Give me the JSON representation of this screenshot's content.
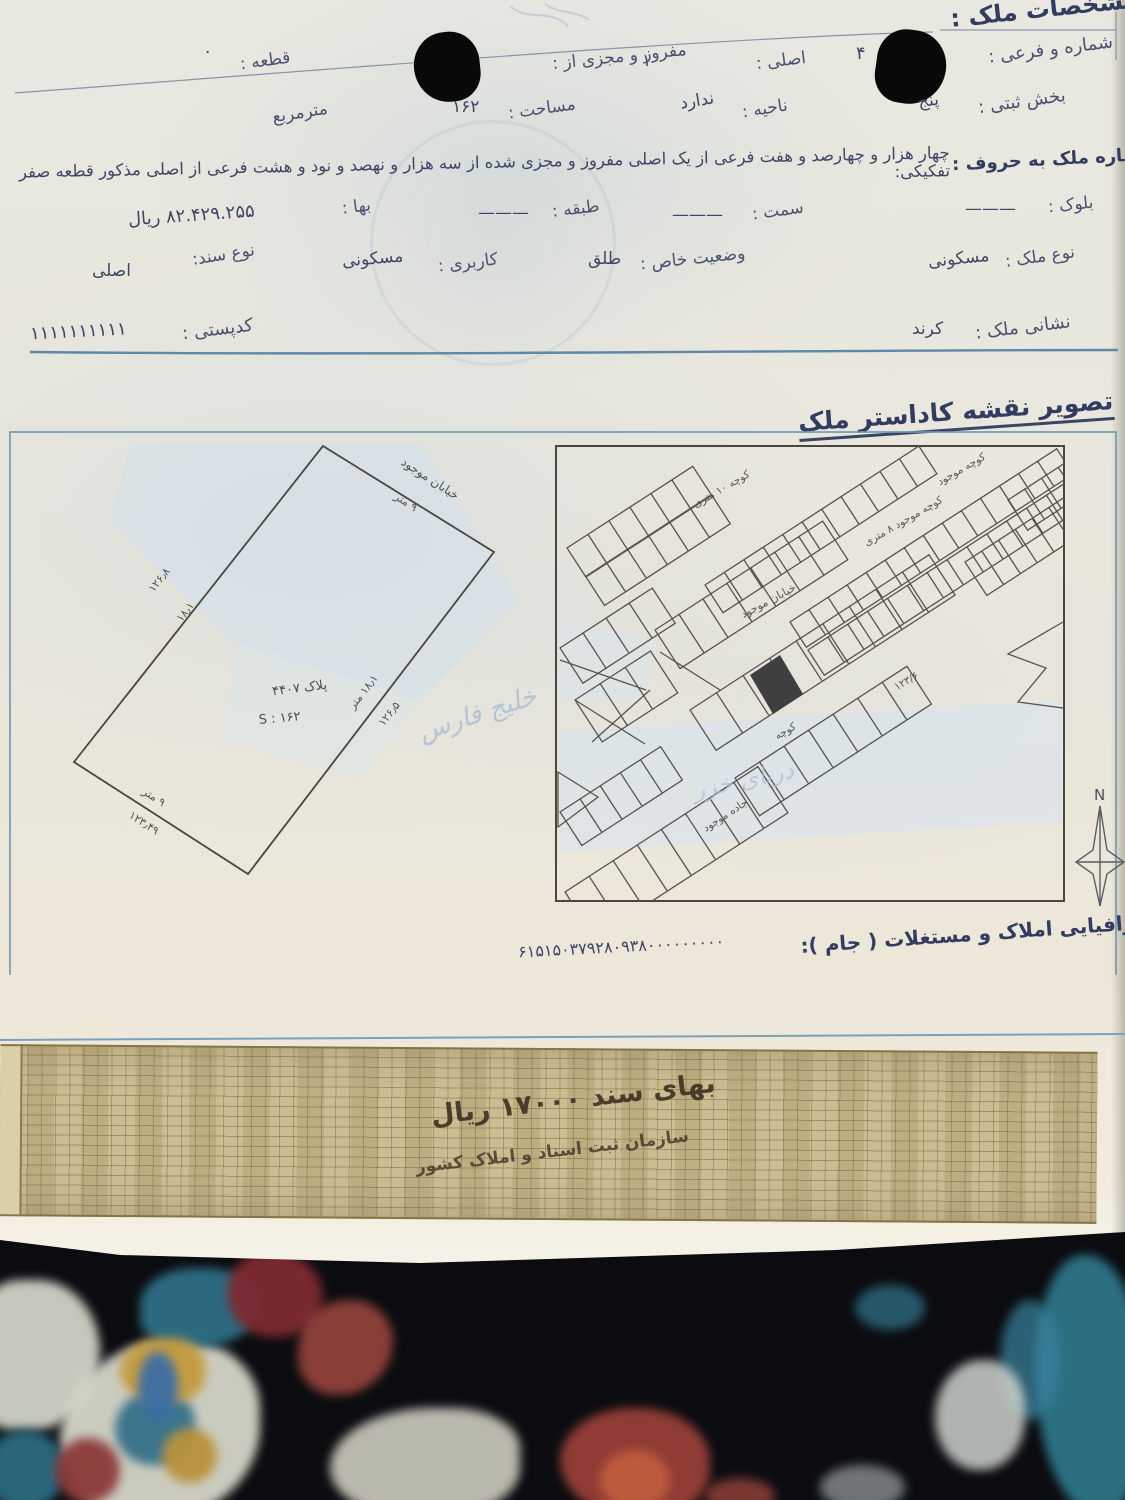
{
  "document": {
    "section1_title": "مشخصات ملک :",
    "fields": {
      "shomare_farei": {
        "label": "شماره و فرعی :",
        "value": "۴"
      },
      "asli": {
        "label": "اصلی :",
        "value": "۱"
      },
      "mafruz": {
        "label": "مفروز و مجزی از :",
        "value": ""
      },
      "ghateh": {
        "label": "قطعه :",
        "value": "·"
      },
      "bakhsh_sabti": {
        "label": "بخش ثبتی :",
        "value": "پنج"
      },
      "nahieh": {
        "label": "ناحیه :",
        "value": "ندارد"
      },
      "masahat": {
        "label": "مساحت :",
        "value": "۱۶۲"
      },
      "unit": "مترمربع",
      "melk_horoof": {
        "label": "شماره ملک به حروف :",
        "value": "چهار هزار و چهارصد و هفت فرعی از یک اصلی مفروز و مجزی شده از سه هزار و نهصد و نود و هشت فرعی از اصلی مذکور قطعه صفر تفکیکی:"
      },
      "block": {
        "label": "بلوک :",
        "value": "———"
      },
      "samt": {
        "label": "سمت :",
        "value": "———"
      },
      "tabagheh": {
        "label": "طبقه :",
        "value": "———"
      },
      "baha": {
        "label": "بها :",
        "value": "۸۲.۴۲۹.۲۵۵ ریال"
      },
      "noe_melk": {
        "label": "نوع ملک :",
        "value": "مسکونی"
      },
      "vaziat_khas": {
        "label": "وضعیت خاص :",
        "value": "طلق"
      },
      "karbari": {
        "label": "کاربری :",
        "value": "مسکونی"
      },
      "noe_sanad": {
        "label": "نوع سند:",
        "value": "اصلی"
      },
      "neshani": {
        "label": "نشانی ملک :",
        "value": "کرند"
      },
      "codposti": {
        "label": "کدپستی :",
        "value": "۱۱۱۱۱۱۱۱۱۱"
      }
    },
    "map_section_title": "تصویر نقشه کاداستر ملک",
    "plan": {
      "street_label": "خیابان موجود",
      "street_width": "۹ متر",
      "dim_left_1": "۱۲۶٫۸",
      "dim_left_2": "۱۸٫۱",
      "dim_right_1": "۱۸٫۱ متر",
      "dim_right_2": "۱۲۶٫۵",
      "dim_bottom_1": "۹ متر",
      "dim_bottom_2": "۱۲۳٫۴۹",
      "plot_label": "پلاک ۴۴۰۷",
      "area_label": "S : ۱۶۲",
      "watermark": "خلیج فارس"
    },
    "city_map": {
      "labels": {
        "l1": "کوچه ۱۰ متری",
        "l2": "کوچه موجود",
        "l3": "کوچه موجود ۸ متری",
        "l4": "خیابان موجود",
        "l5": "۱۲۳/۶",
        "l6": "کوچه",
        "l7": "جاده موجود"
      },
      "watermark": "دریای خزر",
      "compass_n": "N"
    },
    "jam": {
      "label": "شناسه ملی جغرافیایی املاک و مستغلات ( جام ):",
      "value": "۶۱۵۱۵۰۳۷۹۲۸۰۹۳۸۰۰۰۰۰۰۰۰۰"
    },
    "stamp": {
      "line1": "بهای سند ۱۷۰۰۰ ریال",
      "line2": "سازمان ثبت اسناد و املاک کشور"
    }
  }
}
